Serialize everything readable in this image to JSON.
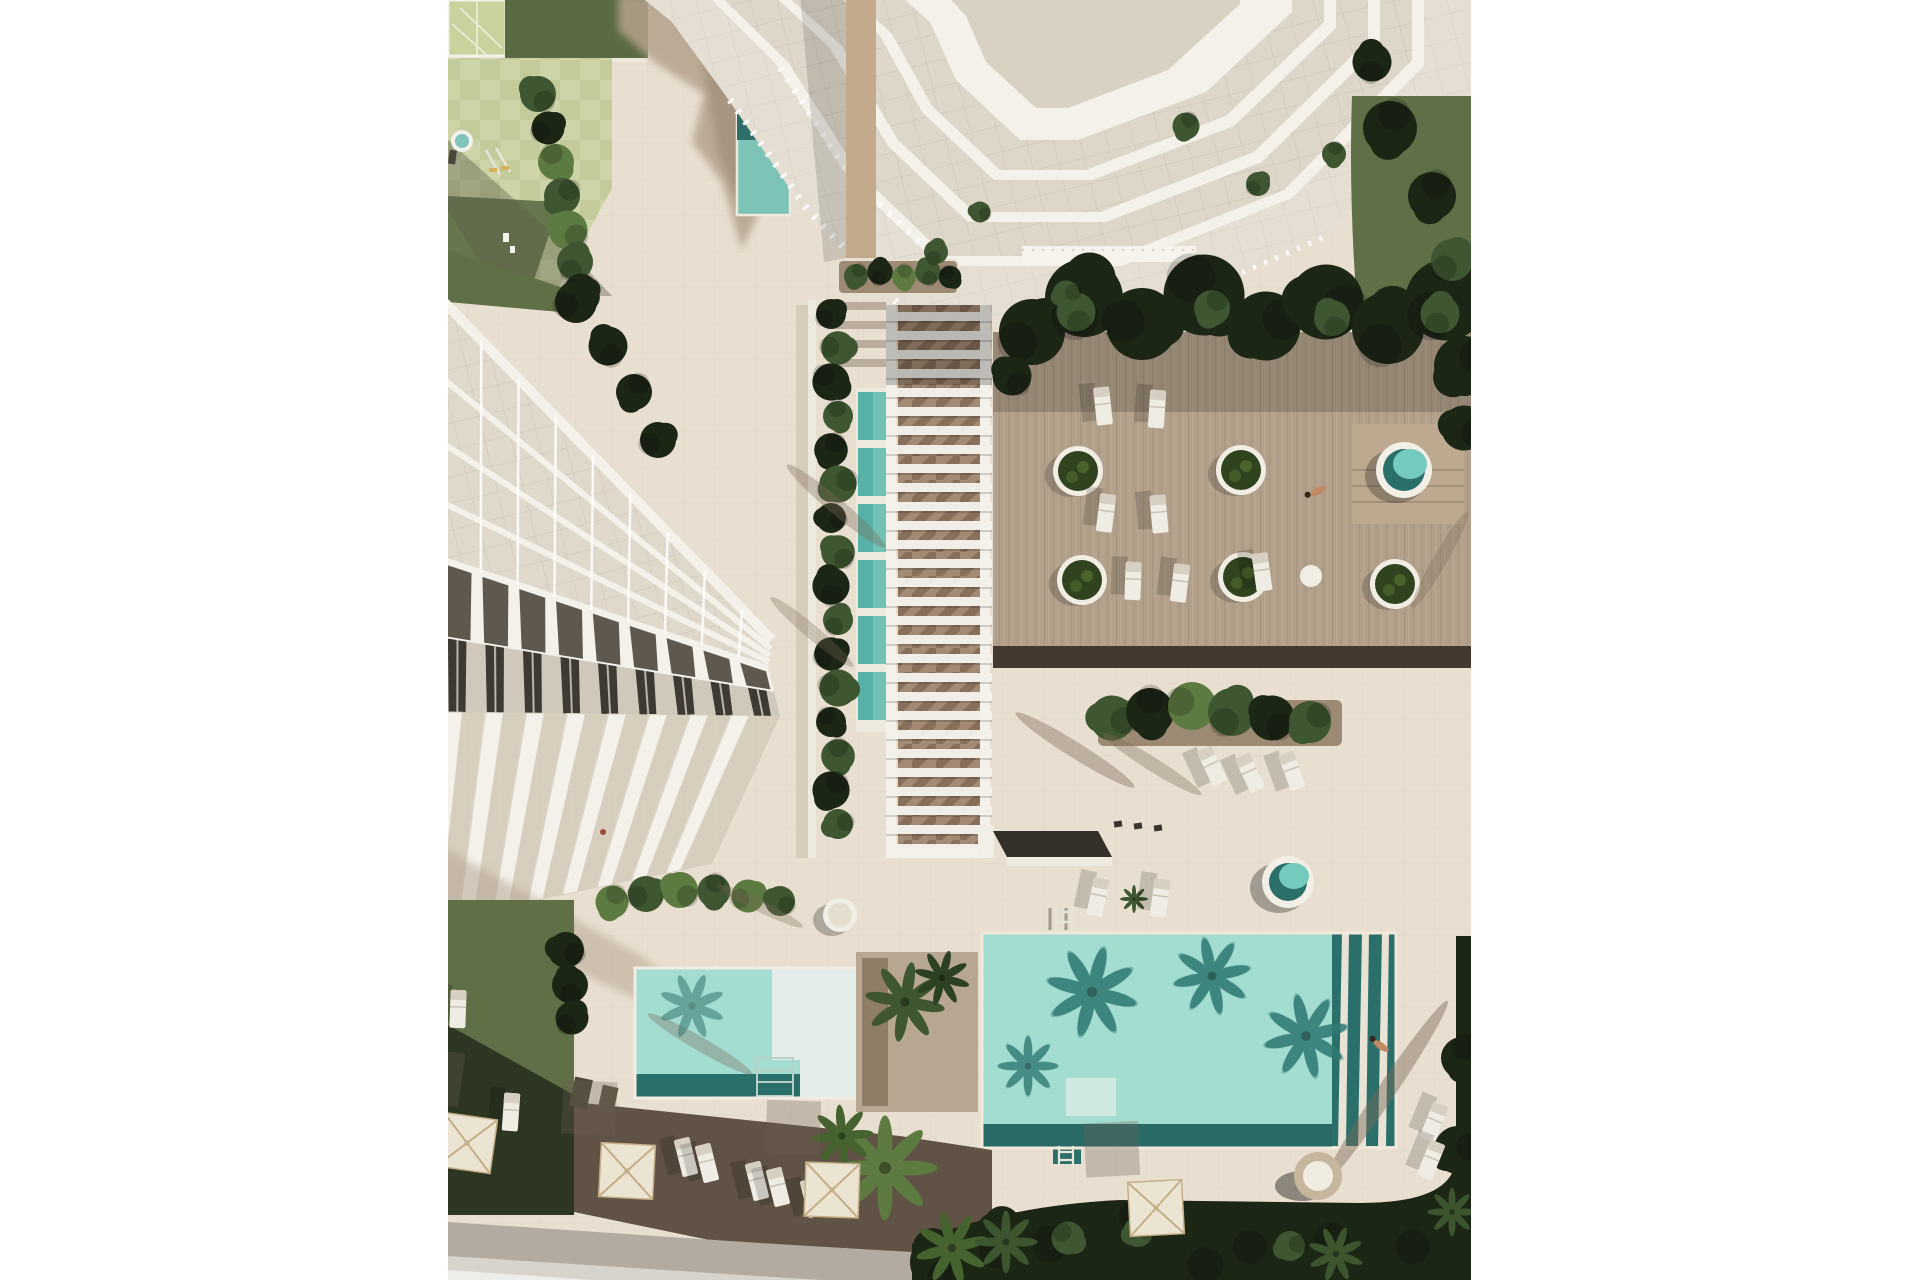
{
  "meta": {
    "description": "Aerial top-down 3D architectural rendering of a coastal residential resort: white high-rise tower with terraced balconies at top, sawtooth low-rise apartment building at left, central slatted pergola walkway with segmented lap pool, timber sun deck with circular planters, hot tub and loungers, two turquoise swimming pools with palm shadows, round spa, parasols, sun loungers, lawns, palm trees and a road at the bottom left. White margins on left and right.",
    "style": "photoreal render, warm beige paving, strong low-sun shadows cast up-left"
  },
  "palette": {
    "margin": "#ffffff",
    "pavement": "#e9dfd0",
    "tile_line": "#d2c5b0",
    "pavement_shadow": "#b3a28d",
    "shadow_deep": "#544738",
    "bldg": "#f4f1ea",
    "bldg_edge": "#d9d1c3",
    "glass": "#d9d1c1",
    "glass_line": "#b4aa99",
    "roof_dark": "#5e584e",
    "window_dark": "#3e3a33",
    "tan_wall": "#c3aa8a",
    "wood": "#b2a08b",
    "deck_dark": "#43392e",
    "grass": "#5f6f46",
    "grass_dark": "#2a3321",
    "veg_dark": "#1c2615",
    "leaf": "#3e5631",
    "leaf_bright": "#5d7a41",
    "pool_light": "#a3dcd1",
    "pool_mid": "#6fbfb4",
    "pool_dark": "#2b6f6a",
    "pool_deep": "#1e5f5c",
    "lap_pool": "#58b1a6",
    "umbrella": "#ece4d2",
    "umbrella_rib": "#c4ae87",
    "lounger": "#efece3",
    "road": "#b4aba0",
    "sidewalk": "#d9d4cb",
    "soil": "#9c8a74",
    "skin": "#c08a64"
  },
  "scene": {
    "content_left": 448,
    "content_right": 1471,
    "building": {
      "units": 9,
      "Ltop": [
        [
          444,
          302
        ],
        [
          772,
          640
        ]
      ],
      "L1": [
        [
          444,
          560
        ],
        [
          768,
          668
        ]
      ],
      "L2": [
        [
          444,
          638
        ],
        [
          774,
          692
        ]
      ],
      "L3": [
        [
          444,
          712
        ],
        [
          780,
          716
        ]
      ],
      "Ltip": [
        [
          430,
          922
        ],
        [
          712,
          864
        ]
      ],
      "slab_fractions": [
        0,
        0.3,
        0.55,
        0.78,
        1
      ],
      "fins": 8
    },
    "pergola": {
      "x": 886,
      "w": 106,
      "y0": 305,
      "y1": 852,
      "slat_step": 19,
      "slat_h": 9
    },
    "pergola_hedge": {
      "x": 834,
      "y0": 314,
      "y1": 852,
      "step": 34
    },
    "lap_segments": {
      "x": 858,
      "w": 30,
      "y0": 392,
      "h": 48,
      "gap": 8,
      "n": 6
    },
    "planters": [
      [
        1078,
        471
      ],
      [
        1082,
        580
      ],
      [
        1241,
        470
      ],
      [
        1243,
        577
      ],
      [
        1395,
        584
      ]
    ],
    "hot_tub": {
      "x": 1404,
      "y": 470
    },
    "spa": {
      "x": 1288,
      "y": 882
    },
    "loungers": [
      [
        1103,
        406,
        -6
      ],
      [
        1157,
        409,
        4
      ],
      [
        1106,
        513,
        7
      ],
      [
        1159,
        514,
        -5
      ],
      [
        1133,
        581,
        2
      ],
      [
        1180,
        583,
        7
      ],
      [
        1262,
        572,
        -8
      ],
      [
        1212,
        766,
        -25
      ],
      [
        1250,
        773,
        -25
      ],
      [
        1292,
        771,
        -20
      ],
      [
        1098,
        897,
        12
      ],
      [
        1160,
        898,
        8
      ],
      [
        1434,
        1122,
        22
      ],
      [
        1431,
        1160,
        22
      ],
      [
        686,
        1157,
        -14
      ],
      [
        707,
        1163,
        -14
      ],
      [
        757,
        1181,
        -14
      ],
      [
        778,
        1187,
        -14
      ],
      [
        812,
        1198,
        -14
      ],
      [
        458,
        1009,
        2
      ],
      [
        511,
        1112,
        4
      ]
    ],
    "umbrellas": [
      [
        467,
        1143,
        8
      ],
      [
        627,
        1171,
        3
      ],
      [
        832,
        1190,
        2
      ],
      [
        1156,
        1208,
        -3
      ]
    ],
    "bollards": [
      [
        1118,
        824
      ],
      [
        1138,
        826
      ],
      [
        1158,
        828
      ]
    ],
    "trees": [
      [
        1032,
        332,
        2.2,
        "veg"
      ],
      [
        1084,
        298,
        2.6,
        "veg"
      ],
      [
        1142,
        324,
        2.4,
        "veg"
      ],
      [
        1204,
        295,
        2.7,
        "veg"
      ],
      [
        1266,
        326,
        2.3,
        "veg"
      ],
      [
        1326,
        302,
        2.5,
        "veg"
      ],
      [
        1388,
        328,
        2.4,
        "veg"
      ],
      [
        1446,
        300,
        2.7,
        "veg"
      ],
      [
        1464,
        366,
        2.0,
        "veg"
      ],
      [
        1464,
        428,
        1.5,
        "veg"
      ],
      [
        1012,
        376,
        1.3,
        "veg"
      ],
      [
        1076,
        312,
        1.3,
        "leaf"
      ],
      [
        1212,
        308,
        1.2,
        "leaf"
      ],
      [
        1332,
        318,
        1.2,
        "leaf"
      ],
      [
        1440,
        314,
        1.3,
        "leaf"
      ],
      [
        1390,
        128,
        1.8,
        "veg"
      ],
      [
        1432,
        196,
        1.6,
        "veg"
      ],
      [
        1372,
        62,
        1.3,
        "veg"
      ],
      [
        1452,
        260,
        1.4,
        "leaf"
      ],
      [
        1112,
        718,
        1.5,
        "leaf"
      ],
      [
        1150,
        712,
        1.6,
        "veg"
      ],
      [
        1192,
        706,
        1.6,
        "leaf_b"
      ],
      [
        1232,
        712,
        1.6,
        "leaf"
      ],
      [
        1272,
        718,
        1.5,
        "veg"
      ],
      [
        1310,
        722,
        1.4,
        "leaf"
      ],
      [
        538,
        94,
        1.2,
        "leaf"
      ],
      [
        548,
        128,
        1.1,
        "veg"
      ],
      [
        556,
        162,
        1.2,
        "leaf_b"
      ],
      [
        562,
        196,
        1.2,
        "leaf"
      ],
      [
        568,
        230,
        1.3,
        "leaf_b"
      ],
      [
        575,
        262,
        1.2,
        "leaf"
      ],
      [
        581,
        290,
        1.1,
        "veg"
      ],
      [
        576,
        302,
        1.4,
        "veg"
      ],
      [
        608,
        346,
        1.3,
        "veg"
      ],
      [
        634,
        392,
        1.2,
        "veg"
      ],
      [
        658,
        440,
        1.2,
        "veg"
      ],
      [
        612,
        902,
        1.1,
        "leaf_b"
      ],
      [
        646,
        894,
        1.2,
        "leaf"
      ],
      [
        680,
        890,
        1.2,
        "leaf_b"
      ],
      [
        714,
        891,
        1.1,
        "leaf"
      ],
      [
        748,
        896,
        1.1,
        "leaf_b"
      ],
      [
        780,
        901,
        1.0,
        "leaf"
      ],
      [
        856,
        276,
        0.8,
        "leaf"
      ],
      [
        880,
        272,
        0.85,
        "veg"
      ],
      [
        904,
        277,
        0.8,
        "leaf_b"
      ],
      [
        928,
        272,
        0.85,
        "leaf"
      ],
      [
        950,
        277,
        0.75,
        "veg"
      ],
      [
        940,
        1262,
        2.0,
        "veg"
      ],
      [
        1000,
        1238,
        1.8,
        "veg"
      ],
      [
        1064,
        1252,
        2.0,
        "veg"
      ],
      [
        1130,
        1230,
        1.8,
        "veg"
      ],
      [
        1196,
        1252,
        2.0,
        "veg"
      ],
      [
        1262,
        1238,
        1.9,
        "veg"
      ],
      [
        1330,
        1256,
        2.0,
        "veg"
      ],
      [
        1398,
        1242,
        1.9,
        "veg"
      ],
      [
        1458,
        1150,
        1.6,
        "veg"
      ],
      [
        1462,
        1058,
        1.4,
        "veg"
      ],
      [
        1068,
        1238,
        1.1,
        "leaf"
      ],
      [
        1138,
        1232,
        1.0,
        "leaf"
      ],
      [
        1290,
        1246,
        1.0,
        "leaf"
      ],
      [
        566,
        950,
        1.2,
        "veg"
      ],
      [
        570,
        985,
        1.2,
        "veg"
      ],
      [
        572,
        1018,
        1.1,
        "veg"
      ],
      [
        1186,
        126,
        0.9,
        "leaf"
      ],
      [
        1258,
        184,
        0.8,
        "leaf"
      ],
      [
        936,
        252,
        0.8,
        "leaf"
      ],
      [
        1066,
        294,
        0.9,
        "leaf"
      ],
      [
        1334,
        154,
        0.8,
        "leaf"
      ],
      [
        980,
        212,
        0.7,
        "leaf"
      ]
    ],
    "palms": [
      [
        905,
        1002,
        1.15,
        "#3e5631",
        1,
        10
      ],
      [
        942,
        978,
        0.8,
        "#2c4023",
        1,
        -30
      ],
      [
        885,
        1168,
        1.5,
        "#5d7a41",
        1,
        0
      ],
      [
        842,
        1136,
        0.9,
        "#46632f",
        1,
        40
      ],
      [
        952,
        1248,
        1.05,
        "#46632f",
        1,
        -15
      ],
      [
        1092,
        992,
        1.3,
        "#2f7a74",
        0.8,
        15
      ],
      [
        1212,
        976,
        1.1,
        "#2f7a74",
        0.8,
        -12
      ],
      [
        1306,
        1036,
        1.2,
        "#2f7a74",
        0.8,
        32
      ],
      [
        1028,
        1066,
        0.85,
        "#2f7a74",
        0.7,
        0
      ],
      [
        692,
        1006,
        0.95,
        "#35776f",
        0.55,
        22
      ],
      [
        1006,
        1242,
        0.9,
        "#3c552e",
        1,
        0
      ],
      [
        1336,
        1254,
        0.8,
        "#3c552e",
        1,
        20
      ],
      [
        1452,
        1212,
        0.7,
        "#3c552e",
        1,
        0
      ],
      [
        1134,
        899,
        0.4,
        "#3e5631",
        1,
        0
      ]
    ],
    "streaks": [
      [
        1075,
        750,
        32,
        70,
        8,
        0.4
      ],
      [
        1152,
        764,
        32,
        58,
        7,
        0.35
      ],
      [
        836,
        506,
        40,
        64,
        8,
        0.35
      ],
      [
        812,
        632,
        40,
        54,
        7,
        0.3
      ],
      [
        1386,
        1092,
        -56,
        110,
        9,
        0.45
      ],
      [
        760,
        906,
        26,
        48,
        6,
        0.3
      ],
      [
        1440,
        560,
        -60,
        56,
        7,
        0.3
      ],
      [
        700,
        1044,
        30,
        60,
        7,
        0.35
      ]
    ],
    "persons": [
      {
        "x": 1318,
        "y": 491,
        "rot": -25,
        "kind": "lying"
      },
      {
        "x": 1381,
        "y": 1046,
        "rot": 35,
        "kind": "lying"
      },
      {
        "x": 603,
        "y": 832,
        "rot": 0,
        "kind": "dot"
      }
    ]
  }
}
